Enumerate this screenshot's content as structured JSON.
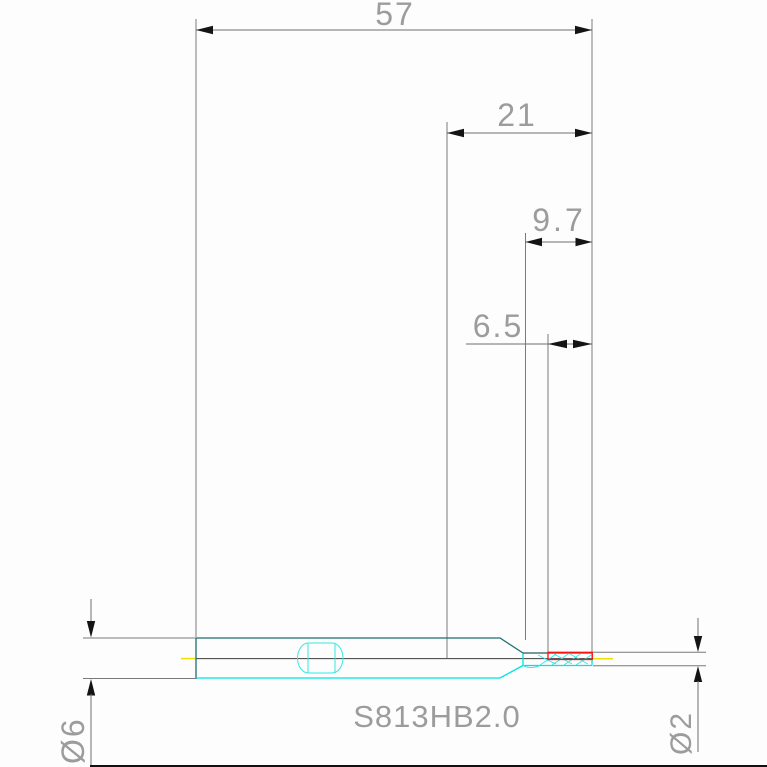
{
  "drawing": {
    "part_number": "S813HB2.0",
    "dimensions": {
      "overall_length": "57",
      "head_length": "21",
      "taper_length": "9.7",
      "flute_length": "6.5",
      "shank_diameter": "Ø6",
      "cutting_diameter": "Ø2"
    },
    "colors": {
      "tool_outline": "#00e4e4",
      "tool_outline_dark": "#1d6f6f",
      "cut_region_highlight": "#ff1111",
      "axis_line": "#eee000",
      "part_number_color": "#7d7df0",
      "dimension_text": "#9c9c9c"
    }
  }
}
